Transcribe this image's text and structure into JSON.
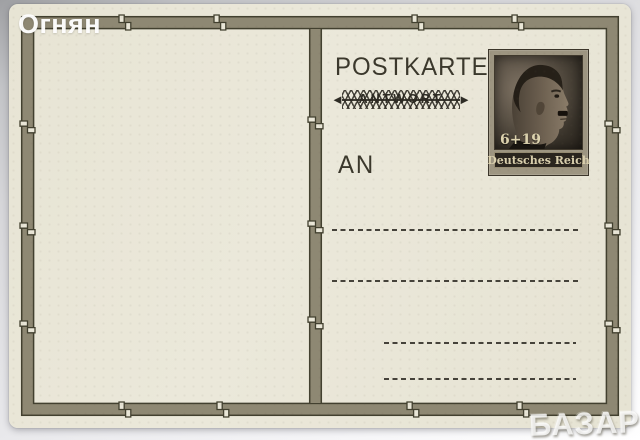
{
  "watermarks": {
    "seller": "Огнян",
    "marketplace": "БАЗАР"
  },
  "postcard": {
    "title": "POSTKARTE",
    "reply_overprint": "ANTWORT",
    "strike_arrow_left": "◄",
    "strike_arrow_right": "►",
    "address_label": "AN",
    "address_line_count": 4,
    "stamp": {
      "denomination": "6+19",
      "country": "Deutsches Reich",
      "subject": "man-profile-portrait"
    },
    "colors": {
      "card_paper": "#e9e6d7",
      "frame_band": "#8e8873",
      "frame_outline": "#42402f",
      "ink": "#3b382c",
      "stamp_mat": "#9d9581",
      "stamp_dark": "#2a251e",
      "stamp_cream": "#d9cfad"
    }
  }
}
